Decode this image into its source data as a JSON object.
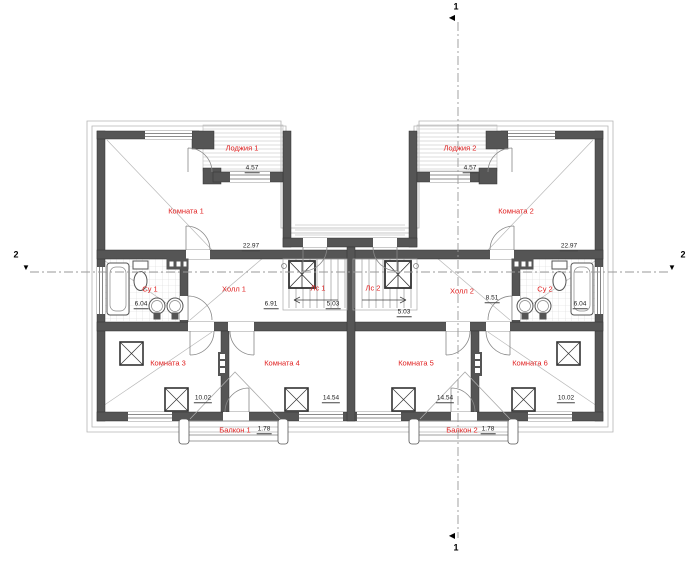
{
  "plan": {
    "type": "architectural-floor-plan",
    "language": "ru",
    "rooms": [
      {
        "label": "Лоджия 1",
        "area": "4.57"
      },
      {
        "label": "Лоджия 2",
        "area": "4.57"
      },
      {
        "label": "Комната 1",
        "area": "22.97"
      },
      {
        "label": "Комната 2",
        "area": "22.97"
      },
      {
        "label": "Су 1",
        "area": "6.04"
      },
      {
        "label": "Су 2",
        "area": "6.04"
      },
      {
        "label": "Холл 1",
        "area": "6.91"
      },
      {
        "label": "Холл 2",
        "area": "8.51"
      },
      {
        "label": "Лс 1",
        "area": "5.03"
      },
      {
        "label": "Лс 2",
        "area": "5.03"
      },
      {
        "label": "Комната 3",
        "area": "10.02"
      },
      {
        "label": "Комната 4",
        "area": "14.54"
      },
      {
        "label": "Комната 5",
        "area": "14.54"
      },
      {
        "label": "Комната 6",
        "area": "10.02"
      },
      {
        "label": "Балкон 1",
        "area": "1.78"
      },
      {
        "label": "Балкон 2",
        "area": "1.78"
      }
    ],
    "section_markers": {
      "vertical": "1",
      "horizontal": "2"
    },
    "colors": {
      "wall": "#555555",
      "room_label": "#e02020",
      "dimension_text": "#222222",
      "thin_line": "#999999"
    }
  }
}
